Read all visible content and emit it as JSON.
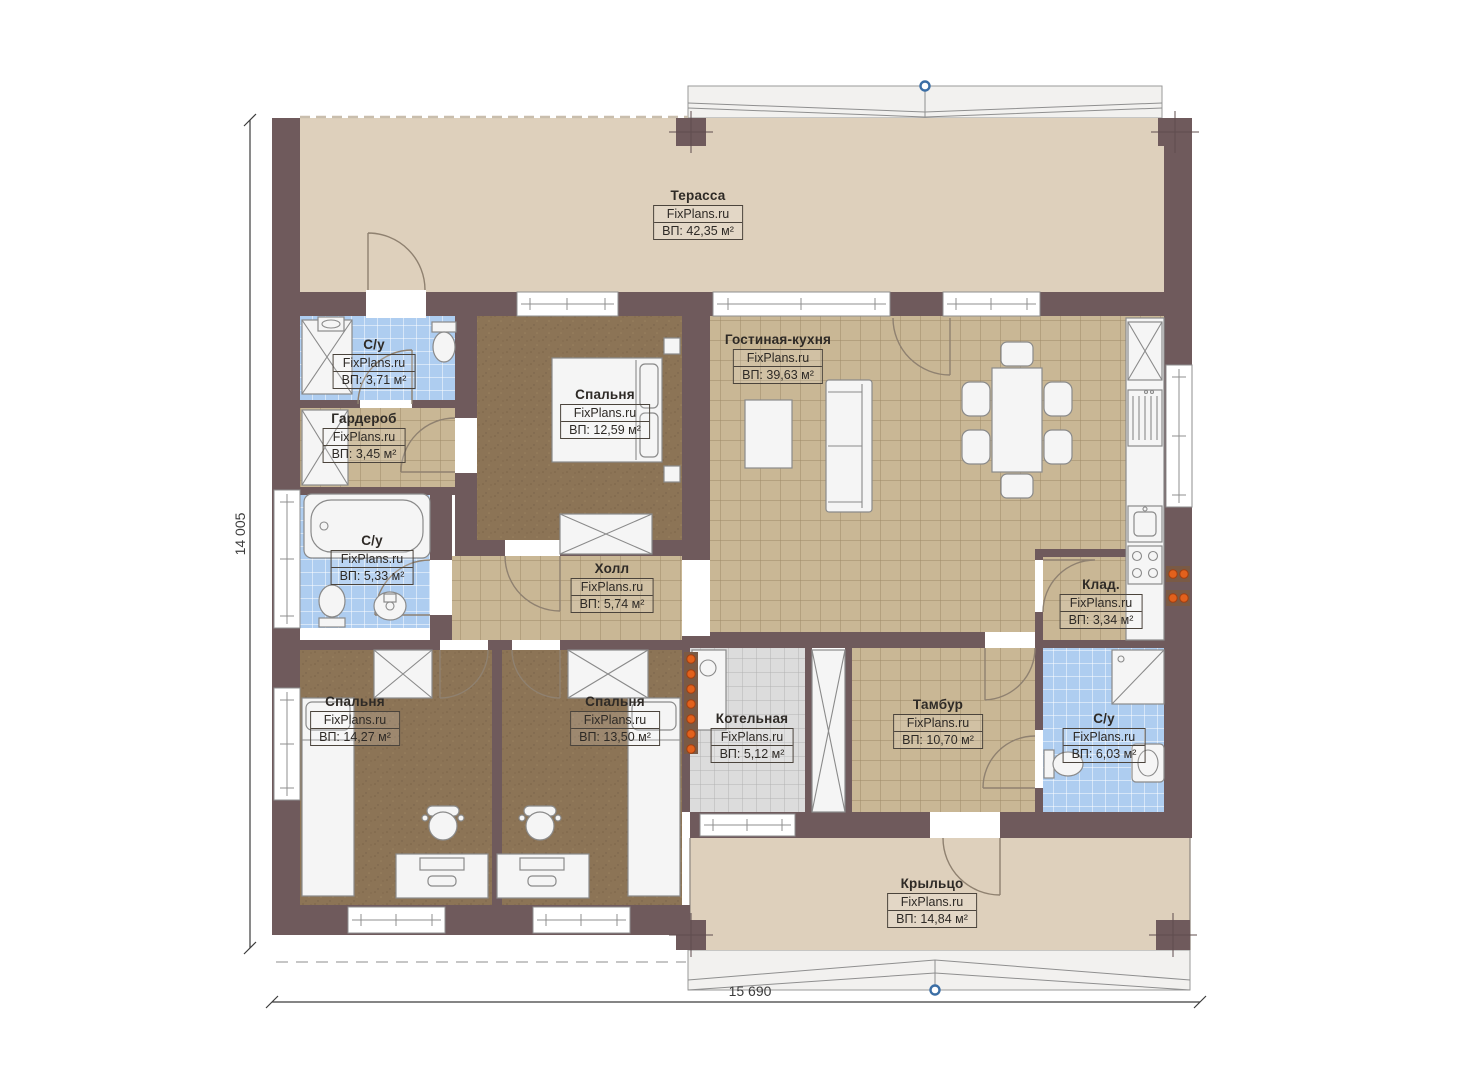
{
  "meta": {
    "type": "floor-plan",
    "brand": "FixPlans.ru"
  },
  "dimensions": {
    "left": "14 005",
    "bottom": "15 690"
  },
  "rooms": [
    {
      "id": "terrace",
      "name": "Терасса",
      "watermark": "FixPlans.ru",
      "area": "ВП: 42,35 м²"
    },
    {
      "id": "bathroom-top",
      "name": "С/у",
      "watermark": "FixPlans.ru",
      "area": "ВП: 3,71 м²"
    },
    {
      "id": "wardrobe",
      "name": "Гардероб",
      "watermark": "FixPlans.ru",
      "area": "ВП: 3,45 м²"
    },
    {
      "id": "bedroom-top",
      "name": "Спальня",
      "watermark": "FixPlans.ru",
      "area": "ВП: 12,59 м²"
    },
    {
      "id": "living-kitchen",
      "name": "Гостиная-кухня",
      "watermark": "FixPlans.ru",
      "area": "ВП: 39,63 м²"
    },
    {
      "id": "bathroom-left",
      "name": "С/у",
      "watermark": "FixPlans.ru",
      "area": "ВП: 5,33 м²"
    },
    {
      "id": "hall",
      "name": "Холл",
      "watermark": "FixPlans.ru",
      "area": "ВП: 5,74 м²"
    },
    {
      "id": "storage",
      "name": "Клад.",
      "watermark": "FixPlans.ru",
      "area": "ВП: 3,34 м²"
    },
    {
      "id": "bedroom-left",
      "name": "Спальня",
      "watermark": "FixPlans.ru",
      "area": "ВП: 14,27 м²"
    },
    {
      "id": "bedroom-middle",
      "name": "Спальня",
      "watermark": "FixPlans.ru",
      "area": "ВП: 13,50 м²"
    },
    {
      "id": "boiler",
      "name": "Котельная",
      "watermark": "FixPlans.ru",
      "area": "ВП: 5,12 м²"
    },
    {
      "id": "vestibule",
      "name": "Тамбур",
      "watermark": "FixPlans.ru",
      "area": "ВП: 10,70 м²"
    },
    {
      "id": "bathroom-right",
      "name": "С/у",
      "watermark": "FixPlans.ru",
      "area": "ВП: 6,03 м²"
    },
    {
      "id": "porch",
      "name": "Крыльцо",
      "watermark": "FixPlans.ru",
      "area": "ВП: 14,84 м²"
    }
  ],
  "colors": {
    "wall": "#6f5a5c",
    "terrace": "#ded0bc",
    "tile_tan": "#c9b795",
    "tile_tan_line": "#9d8a68",
    "carpet": "#8c7456",
    "tile_blue": "#aecdf0",
    "tile_gray": "#dcdcdc",
    "roof": "#f2f1ef",
    "marker_blue": "#3b6ea5",
    "radiator": "#e2611c",
    "label": "#2e2a26",
    "dim": "#3c3c3c"
  }
}
